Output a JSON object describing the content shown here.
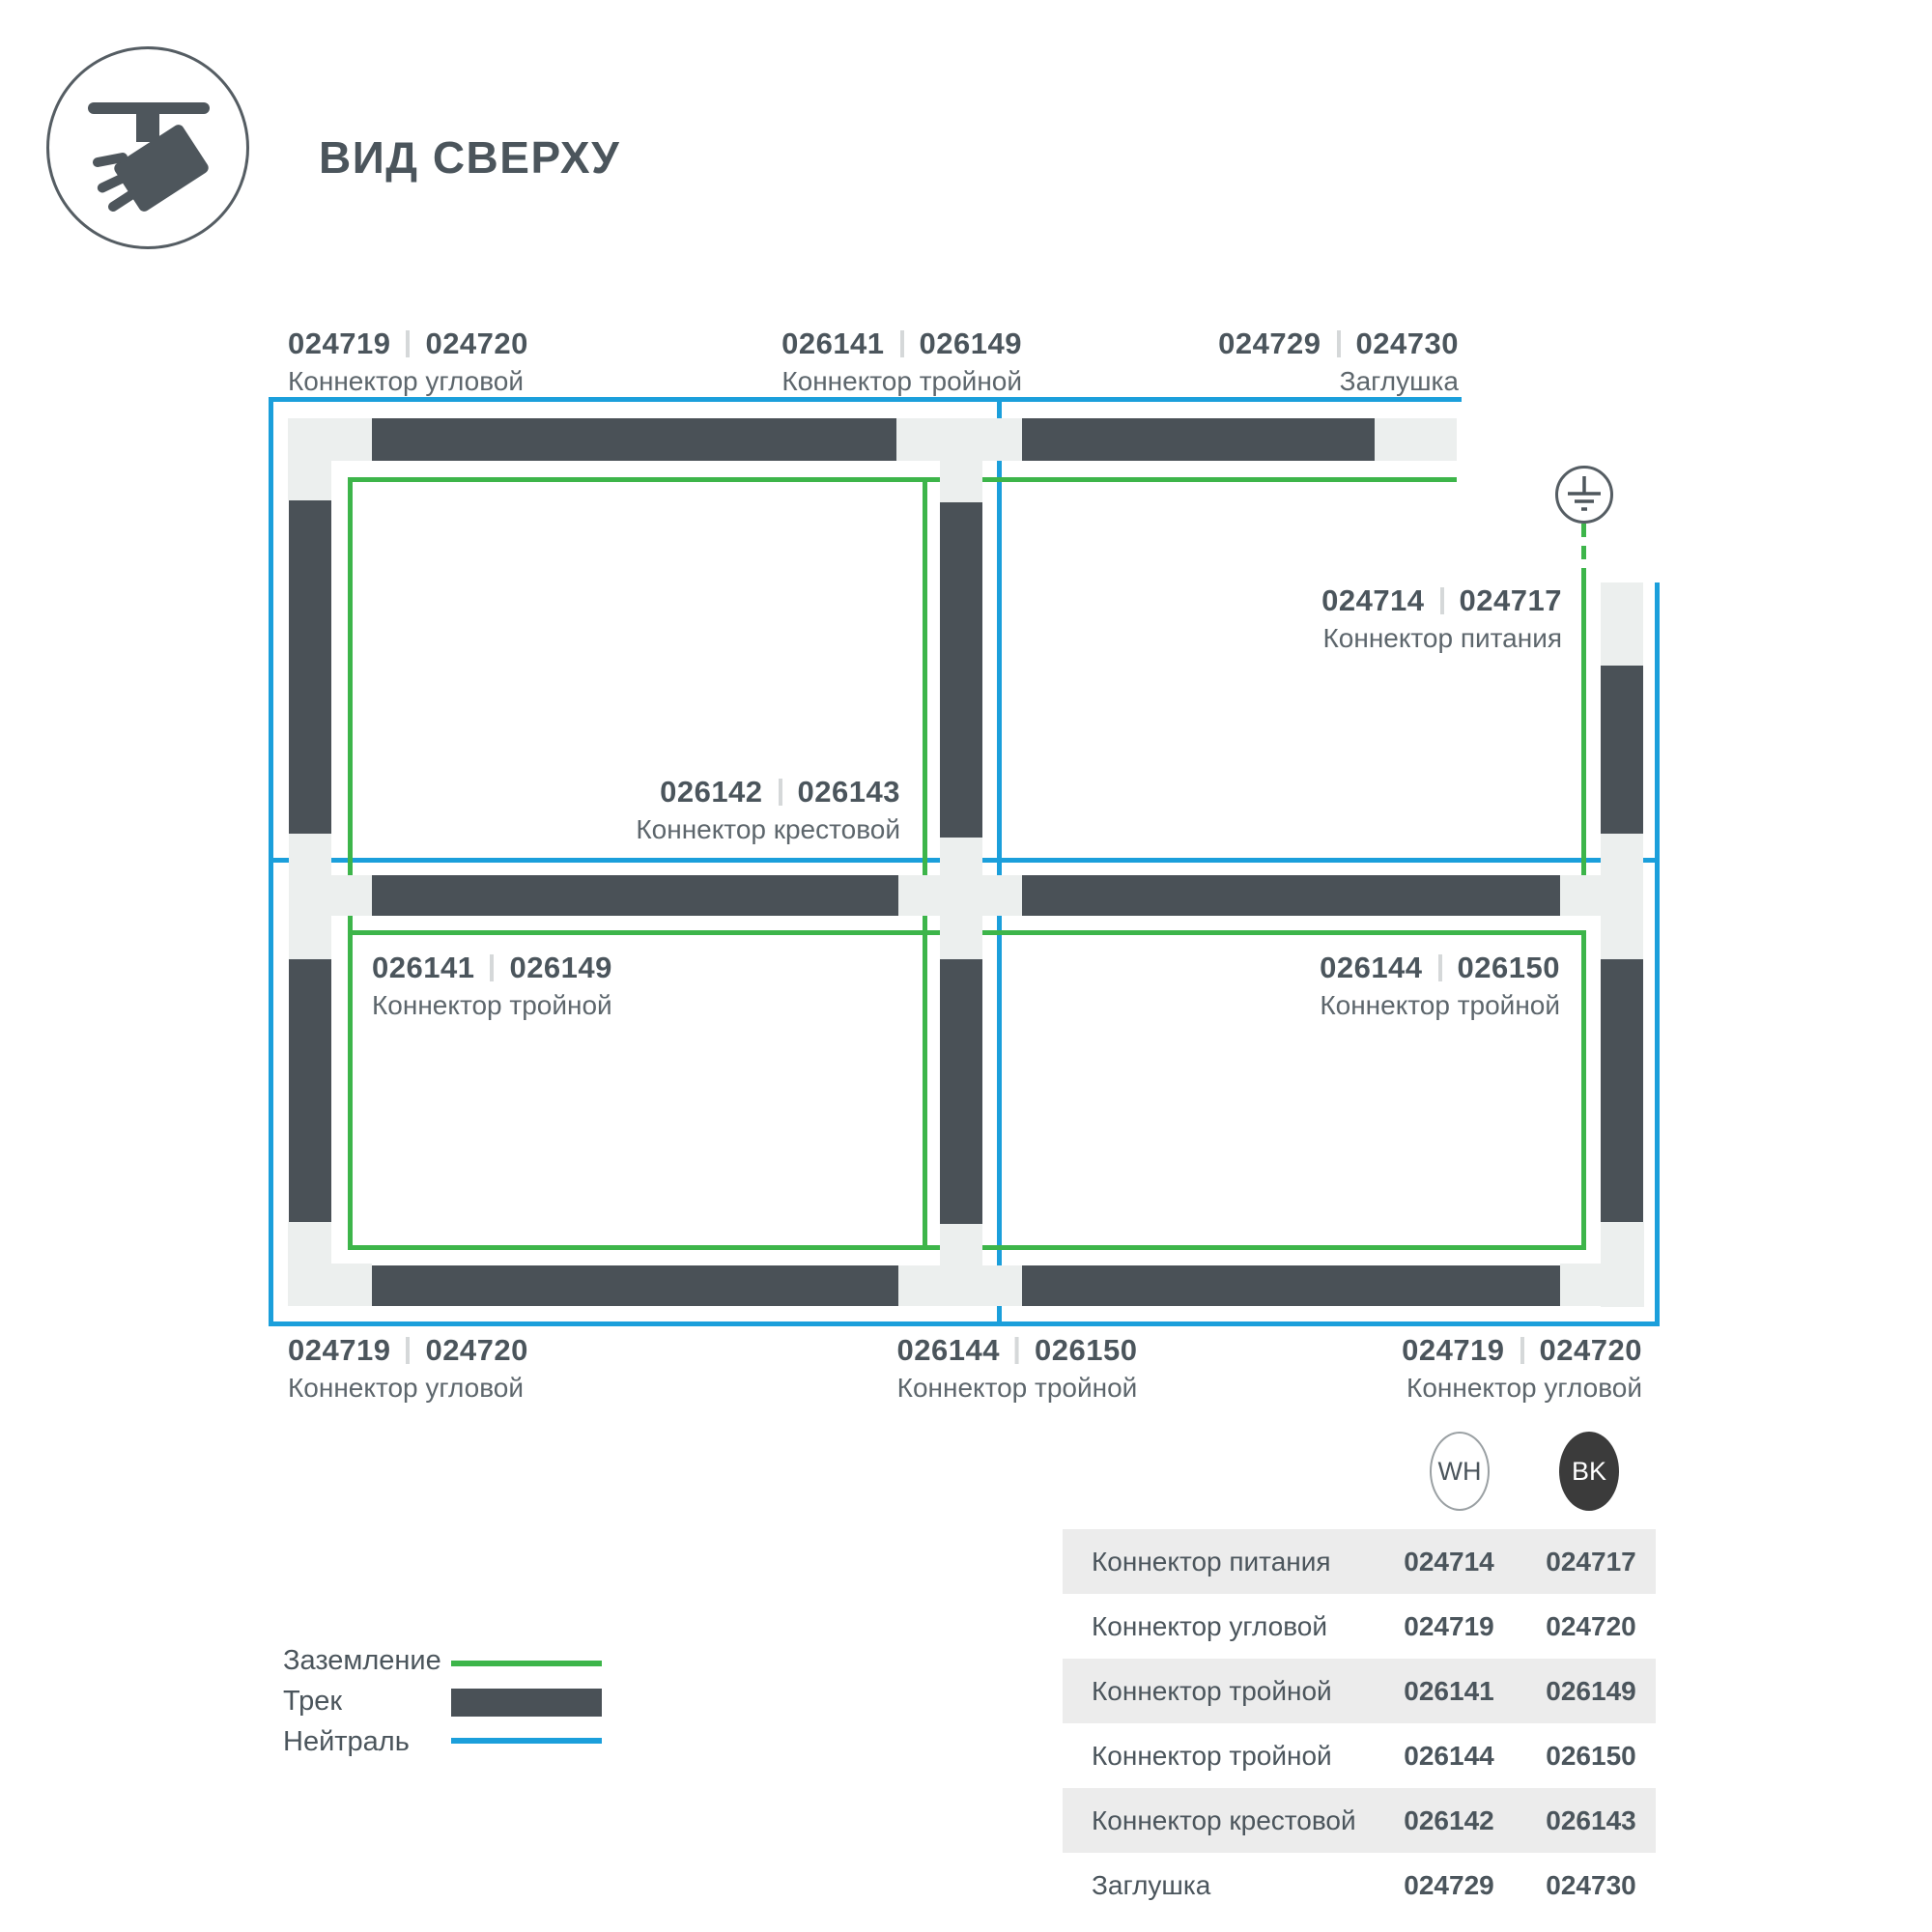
{
  "header": {
    "title": "ВИД СВЕРХУ"
  },
  "icons": {
    "header": "track-light-top-view-icon",
    "ground": "earth-ground-icon"
  },
  "colors": {
    "track": "#4a5157",
    "connector": "#ecefee",
    "ground_green": "#3db54a",
    "neutral_blue": "#1b9fdb",
    "text_dark": "#4b555c",
    "text_muted": "#5d666c",
    "table_alt_row": "#ececec",
    "badge_bk_bg": "#3b3b3b"
  },
  "diagram": {
    "labels": [
      {
        "code_wh": "024719",
        "code_bk": "024720",
        "name": "Коннектор угловой"
      },
      {
        "code_wh": "026141",
        "code_bk": "026149",
        "name": "Коннектор тройной"
      },
      {
        "code_wh": "024729",
        "code_bk": "024730",
        "name": "Заглушка"
      },
      {
        "code_wh": "024714",
        "code_bk": "024717",
        "name": "Коннектор питания"
      },
      {
        "code_wh": "026142",
        "code_bk": "026143",
        "name": "Коннектор крестовой"
      },
      {
        "code_wh": "026141",
        "code_bk": "026149",
        "name": "Коннектор тройной"
      },
      {
        "code_wh": "026144",
        "code_bk": "026150",
        "name": "Коннектор тройной"
      },
      {
        "code_wh": "024719",
        "code_bk": "024720",
        "name": "Коннектор угловой"
      },
      {
        "code_wh": "026144",
        "code_bk": "026150",
        "name": "Коннектор тройной"
      },
      {
        "code_wh": "024719",
        "code_bk": "024720",
        "name": "Коннектор угловой"
      }
    ]
  },
  "legend": {
    "items": [
      {
        "label": "Заземление",
        "type": "ground-line"
      },
      {
        "label": "Трек",
        "type": "track-bar"
      },
      {
        "label": "Нейтраль",
        "type": "neutral-line"
      }
    ]
  },
  "table": {
    "badges": {
      "wh": "WH",
      "bk": "BK"
    },
    "rows": [
      {
        "name": "Коннектор питания",
        "wh": "024714",
        "bk": "024717"
      },
      {
        "name": "Коннектор угловой",
        "wh": "024719",
        "bk": "024720"
      },
      {
        "name": "Коннектор тройной",
        "wh": "026141",
        "bk": "026149"
      },
      {
        "name": "Коннектор тройной",
        "wh": "026144",
        "bk": "026150"
      },
      {
        "name": "Коннектор крестовой",
        "wh": "026142",
        "bk": "026143"
      },
      {
        "name": "Заглушка",
        "wh": "024729",
        "bk": "024730"
      }
    ]
  }
}
